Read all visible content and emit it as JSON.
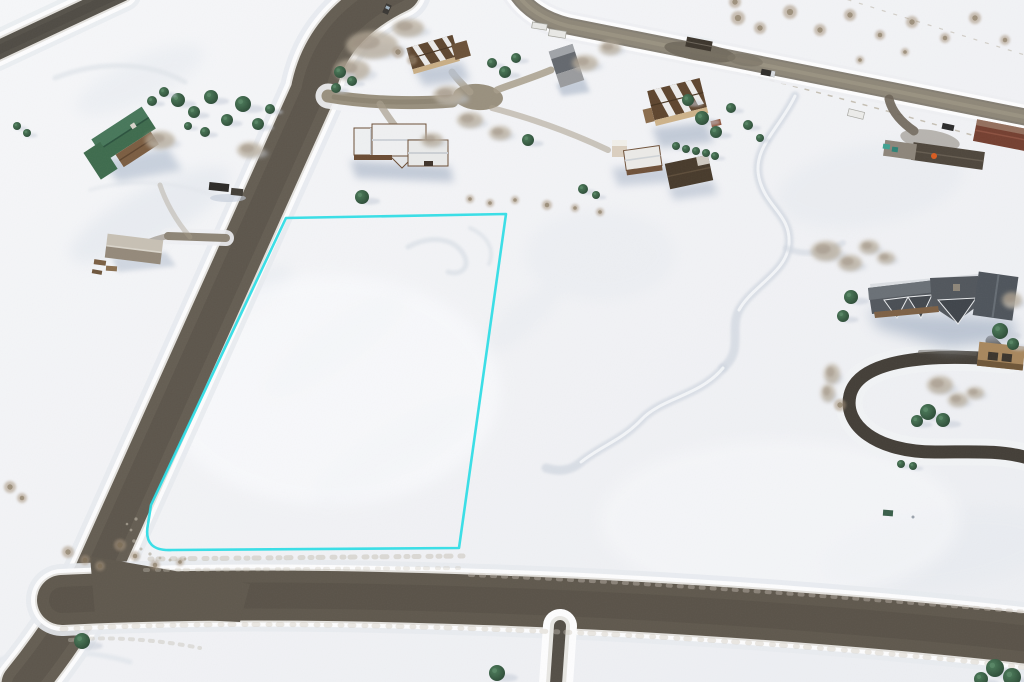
{
  "scene": {
    "type": "aerial-drone-photograph",
    "setting": "snow-covered rural residential subdivision in winter, oblique overhead view",
    "subject": "vacant land parcel outlined in cyan beside a plowed gravel road",
    "visible_text": "none"
  },
  "palette": {
    "snow": "#f2f3f6",
    "snow_bright": "#fbfcfe",
    "snow_shadow": "#dce2ea",
    "berm_white": "#fdfdfe",
    "road": "#645d52",
    "road_dark": "#524c43",
    "highway": "#8e8778",
    "street": "#99907e",
    "loop_driveway": "#433e37",
    "south_driveway": "#534e46",
    "outline_cyan": "#2edde6",
    "conifer_dark": "#2b4935",
    "conifer_light": "#4d7d5b",
    "aspen": "#b6aa98",
    "brush": "#a6937b",
    "roof_green": "#3e6b4d",
    "roof_white": "#eff0f1",
    "roof_tan_brown": "#5e462f",
    "wall_tan": "#c9ae85",
    "roof_gray": "#64686e",
    "mansion_roof": "#53585e",
    "barn_red": "#743f30",
    "shed_dark": "#473a2b",
    "wood_brown": "#7b5d41"
  },
  "lot_outline": {
    "color": "#2edde6",
    "stroke_width": 2.6,
    "shape": "four-sided vacant parcel with rounded southwest corner, long side following the road",
    "corners_px": [
      [
        286,
        218
      ],
      [
        506,
        214
      ],
      [
        459,
        548
      ],
      [
        172,
        550
      ],
      [
        151,
        505
      ]
    ]
  },
  "roads": [
    {
      "id": "road-a",
      "kind": "plowed gravel road",
      "note": "runs diagonally from top center to Y-junction at lower left"
    },
    {
      "id": "road-b",
      "kind": "plowed gravel road",
      "note": "runs along the bottom of the frame from the Y-junction to the right edge"
    },
    {
      "id": "highway",
      "kind": "rural highway with pullout and kiosk",
      "note": "upper right, exits right edge"
    },
    {
      "id": "culdesac-street",
      "kind": "short side street ending in cul-de-sac bulb"
    },
    {
      "id": "road-topleft",
      "kind": "road segment clipped by top-left corner"
    },
    {
      "id": "loop-driveway",
      "kind": "dark horseshoe driveway of the large log home"
    },
    {
      "id": "south-driveway",
      "kind": "narrow plowed driveway leaving the bottom road between snowbanks"
    }
  ],
  "buildings": [
    {
      "id": "green-roof-house",
      "desc": "L-shaped cabin with green gabled roof and log deck",
      "area": "left"
    },
    {
      "id": "gray-shed",
      "desc": "small outbuilding with gray roof and woodpiles",
      "area": "left"
    },
    {
      "id": "snowy-roof-house",
      "desc": "log home with snow-covered white roof and garage",
      "area": "center, east of road-a"
    },
    {
      "id": "tan-house-upper",
      "desc": "brown-roofed house with snow stripes",
      "area": "top center"
    },
    {
      "id": "gray-two-story-house",
      "desc": "narrow gray two-story house",
      "area": "top center-right"
    },
    {
      "id": "tan-house-large",
      "desc": "large brown metal roof with snow chevrons, tan walls",
      "area": "upper right of center"
    },
    {
      "id": "tower-house-cluster",
      "desc": "home with cream tower plus dark-roofed shed",
      "area": "right of center"
    },
    {
      "id": "log-mansion",
      "desc": "large log mansion, multi-gabled slate roof, horseshoe driveway",
      "area": "right"
    },
    {
      "id": "ranch-barns",
      "desc": "red barn, long gray sheds, equipment yard",
      "area": "far right edge on highway"
    }
  ],
  "vehicles": [
    {
      "id": "car-on-road-a",
      "color": "#3a3733"
    },
    {
      "id": "truck-with-trailer-left",
      "color": "#2c2a27"
    },
    {
      "id": "truck-on-highway",
      "color": "#2f2d2a"
    },
    {
      "id": "car-at-ranch",
      "color": "#2b2b2b"
    },
    {
      "id": "white-trailers-top",
      "color": "#e8e8e5"
    },
    {
      "id": "red-truck-at-tan-house",
      "color": "#8a4a2e"
    }
  ],
  "vegetation": {
    "conifers": [
      [
        178,
        100,
        7
      ],
      [
        194,
        112,
        6
      ],
      [
        211,
        97,
        7
      ],
      [
        227,
        120,
        6
      ],
      [
        243,
        104,
        8
      ],
      [
        258,
        124,
        6
      ],
      [
        270,
        109,
        5
      ],
      [
        205,
        132,
        5
      ],
      [
        188,
        126,
        4
      ],
      [
        152,
        101,
        5
      ],
      [
        164,
        92,
        5
      ],
      [
        17,
        126,
        4
      ],
      [
        27,
        133,
        4
      ],
      [
        340,
        72,
        6
      ],
      [
        352,
        81,
        5
      ],
      [
        336,
        88,
        5
      ],
      [
        492,
        63,
        5
      ],
      [
        505,
        72,
        6
      ],
      [
        516,
        58,
        5
      ],
      [
        528,
        140,
        6
      ],
      [
        583,
        189,
        5
      ],
      [
        596,
        195,
        4
      ],
      [
        362,
        197,
        7
      ],
      [
        676,
        146,
        4
      ],
      [
        686,
        149,
        4
      ],
      [
        696,
        151,
        4
      ],
      [
        706,
        153,
        4
      ],
      [
        715,
        156,
        4
      ],
      [
        688,
        100,
        6
      ],
      [
        702,
        118,
        7
      ],
      [
        716,
        132,
        6
      ],
      [
        731,
        108,
        5
      ],
      [
        748,
        125,
        5
      ],
      [
        760,
        138,
        4
      ],
      [
        851,
        297,
        7
      ],
      [
        843,
        316,
        6
      ],
      [
        1000,
        331,
        8
      ],
      [
        1013,
        344,
        6
      ],
      [
        928,
        412,
        8
      ],
      [
        943,
        420,
        7
      ],
      [
        917,
        421,
        6
      ],
      [
        901,
        464,
        4
      ],
      [
        913,
        466,
        4
      ],
      [
        995,
        668,
        9
      ],
      [
        1012,
        677,
        9
      ],
      [
        981,
        679,
        7
      ],
      [
        497,
        673,
        8
      ],
      [
        82,
        641,
        8
      ]
    ],
    "aspen_clumps": [
      [
        372,
        45,
        26,
        14
      ],
      [
        352,
        70,
        18,
        11
      ],
      [
        408,
        28,
        16,
        9
      ],
      [
        448,
        95,
        15,
        9
      ],
      [
        470,
        120,
        13,
        8
      ],
      [
        500,
        133,
        11,
        7
      ],
      [
        160,
        140,
        15,
        9
      ],
      [
        250,
        150,
        13,
        8
      ],
      [
        585,
        63,
        13,
        8
      ],
      [
        610,
        48,
        11,
        7
      ],
      [
        826,
        251,
        15,
        10
      ],
      [
        850,
        263,
        12,
        8
      ],
      [
        869,
        247,
        10,
        7
      ],
      [
        886,
        258,
        9,
        6
      ],
      [
        940,
        385,
        13,
        9
      ],
      [
        958,
        400,
        10,
        7
      ],
      [
        975,
        393,
        9,
        6
      ],
      [
        1012,
        300,
        10,
        8
      ],
      [
        432,
        140,
        11,
        7
      ],
      [
        832,
        374,
        8,
        10
      ],
      [
        828,
        393,
        7,
        9
      ]
    ],
    "brush": [
      [
        470,
        199,
        4
      ],
      [
        490,
        203,
        4
      ],
      [
        515,
        200,
        4
      ],
      [
        547,
        205,
        5
      ],
      [
        575,
        208,
        4
      ],
      [
        600,
        212,
        4
      ],
      [
        10,
        487,
        6
      ],
      [
        22,
        498,
        5
      ],
      [
        68,
        552,
        6
      ],
      [
        85,
        560,
        5
      ],
      [
        100,
        566,
        5
      ],
      [
        120,
        545,
        6
      ],
      [
        135,
        556,
        5
      ],
      [
        155,
        565,
        5
      ],
      [
        180,
        562,
        4
      ],
      [
        398,
        52,
        6
      ],
      [
        412,
        60,
        5
      ],
      [
        738,
        18,
        7
      ],
      [
        760,
        28,
        6
      ],
      [
        790,
        12,
        7
      ],
      [
        820,
        30,
        6
      ],
      [
        850,
        15,
        6
      ],
      [
        880,
        35,
        5
      ],
      [
        912,
        22,
        6
      ],
      [
        945,
        38,
        5
      ],
      [
        975,
        18,
        6
      ],
      [
        1005,
        40,
        5
      ],
      [
        735,
        2,
        6
      ],
      [
        905,
        52,
        4
      ],
      [
        860,
        60,
        4
      ],
      [
        840,
        405,
        6
      ]
    ]
  }
}
